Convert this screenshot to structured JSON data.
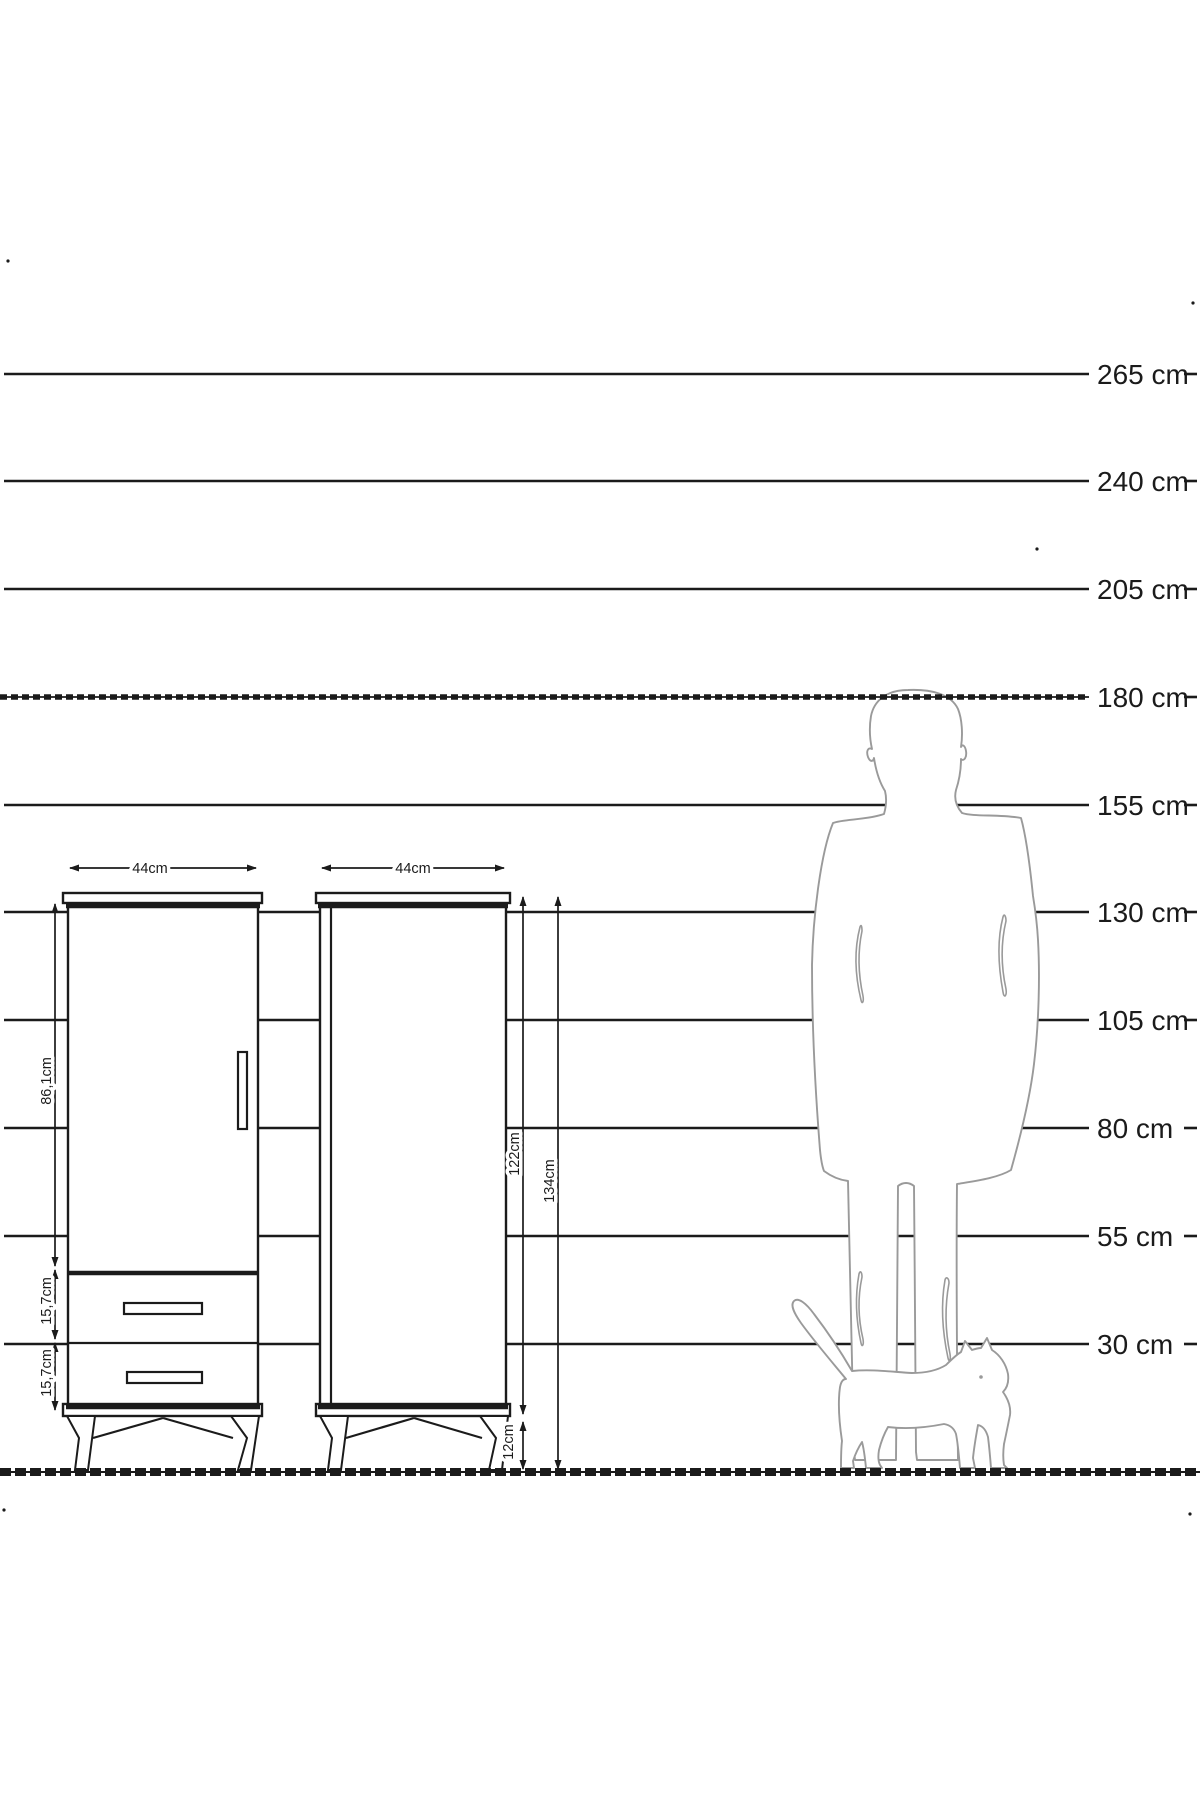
{
  "ruler": {
    "unit": "cm",
    "labels": [
      "265 cm",
      "240 cm",
      "205 cm",
      "180 cm",
      "155 cm",
      "130 cm",
      "105 cm",
      "80 cm",
      "55 cm",
      "30 cm"
    ]
  },
  "cabinets": {
    "left": {
      "width": "44cm",
      "door_height": "86,1cm",
      "drawer_top_height": "15,7cm",
      "drawer_bottom_height": "15,7cm"
    },
    "right": {
      "width": "44cm",
      "body_height": "122cm",
      "total_height": "134cm",
      "leg_height": "12cm"
    }
  },
  "figures": {
    "man": "man-silhouette",
    "cat": "cat-silhouette"
  },
  "colors": {
    "ink": "#1b1b1b",
    "silhouette": "#9a9a9a",
    "background": "#ffffff"
  }
}
